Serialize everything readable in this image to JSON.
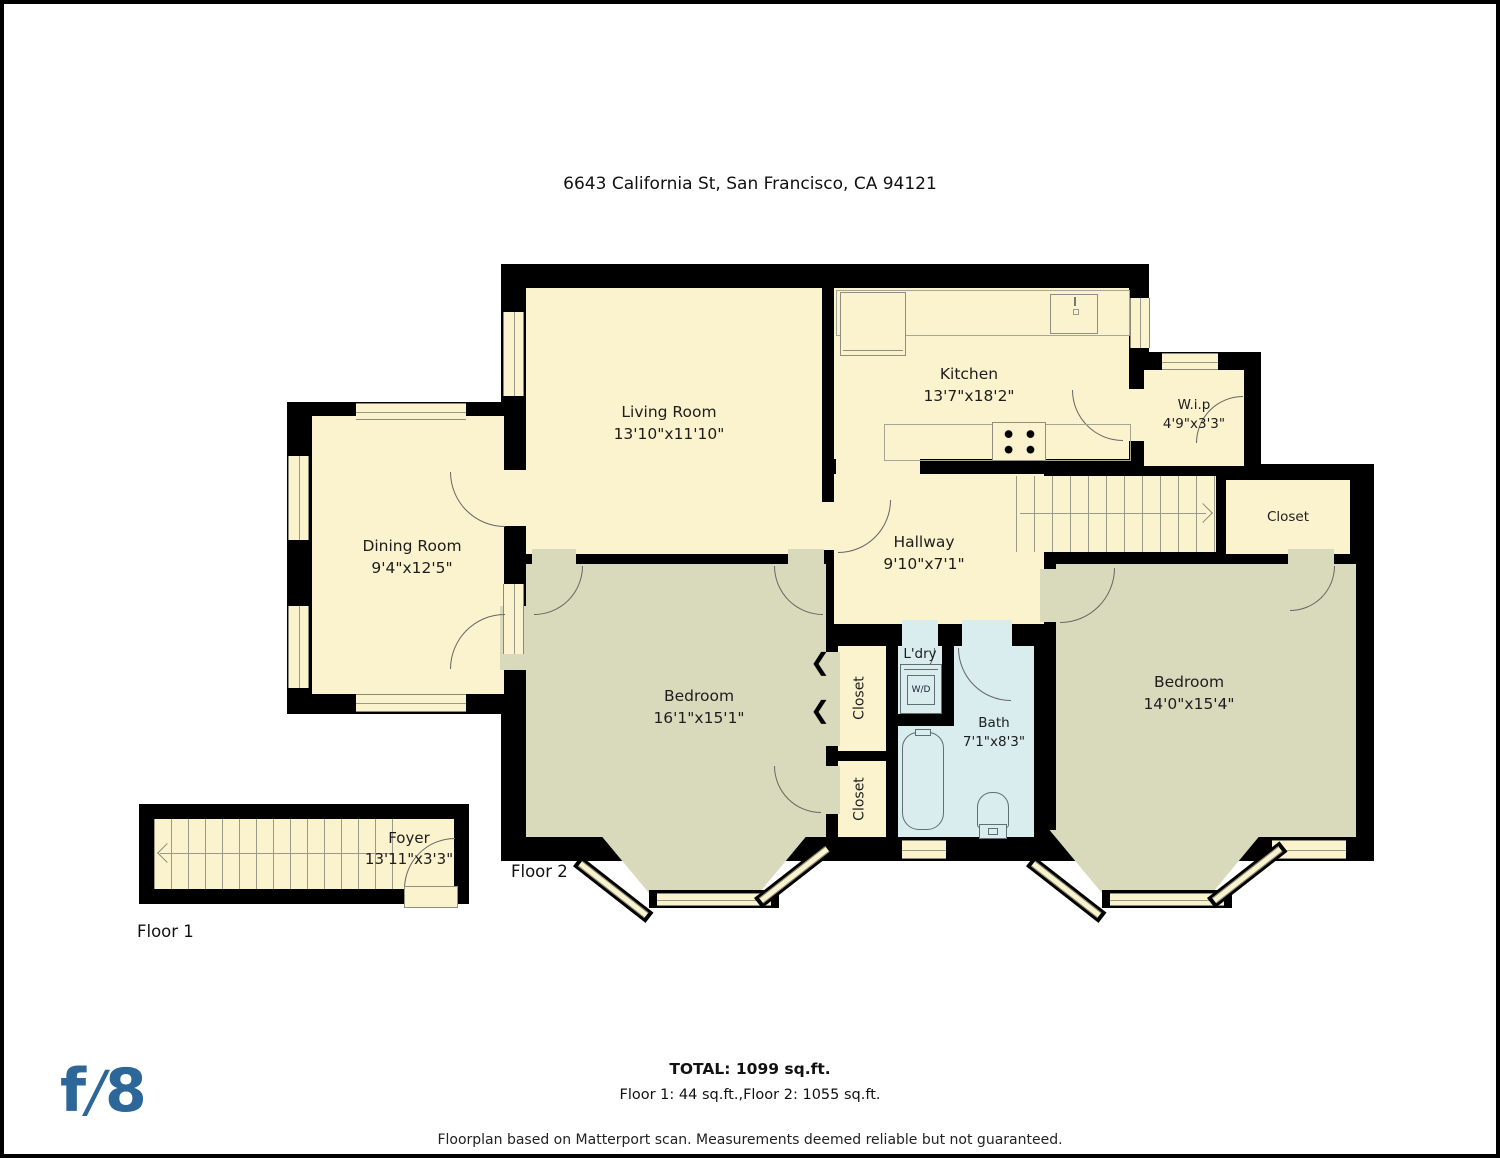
{
  "title": "6643 California St, San Francisco, CA 94121",
  "colors": {
    "wall": "#000000",
    "room_fill": "#faf3cd",
    "bedroom_fill": "#d9dabc",
    "bath_fill": "#d9ecee",
    "logo_blue": "#2d6699",
    "background": "#ffffff"
  },
  "rooms": {
    "living": {
      "name": "Living Room",
      "dims": "13'10\"x11'10\""
    },
    "kitchen": {
      "name": "Kitchen",
      "dims": "13'7\"x18'2\""
    },
    "wip": {
      "name": "W.i.p",
      "dims": "4'9\"x3'3\""
    },
    "dining": {
      "name": "Dining Room",
      "dims": "9'4\"x12'5\""
    },
    "hallway": {
      "name": "Hallway",
      "dims": "9'10\"x7'1\""
    },
    "closet_right": {
      "name": "Closet"
    },
    "bedroom_left": {
      "name": "Bedroom",
      "dims": "16'1\"x15'1\""
    },
    "bedroom_right": {
      "name": "Bedroom",
      "dims": "14'0\"x15'4\""
    },
    "laundry": {
      "name": "L'dry",
      "appliance": "W/D"
    },
    "bath": {
      "name": "Bath",
      "dims": "7'1\"x8'3\""
    },
    "closet_mid_upper": {
      "name": "Closet"
    },
    "closet_mid_lower": {
      "name": "Closet"
    },
    "foyer": {
      "name": "Foyer",
      "dims": "13'11\"x3'3\""
    }
  },
  "floor_labels": {
    "floor1": "Floor 1",
    "floor2": "Floor 2"
  },
  "summary": {
    "total": "TOTAL: 1099 sq.ft.",
    "floors": "Floor 1: 44 sq.ft.,Floor 2: 1055 sq.ft."
  },
  "disclaimer": "Floorplan based on Matterport scan. Measurements deemed reliable but not guaranteed.",
  "logo": {
    "f": "f",
    "slash": "/",
    "eight": "8"
  }
}
